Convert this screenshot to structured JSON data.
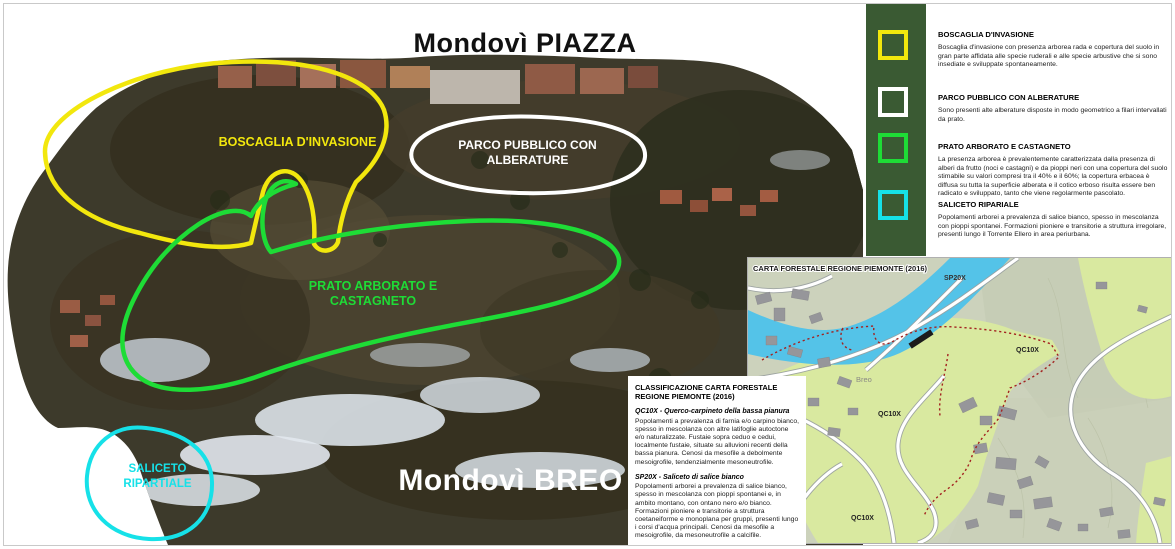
{
  "main_map": {
    "district_top_label": "Mondovì PIAZZA",
    "district_bottom_label": "Mondovì BREO",
    "regions": [
      {
        "label": "BOSCAGLIA D'INVASIONE",
        "color": "#f2e70d"
      },
      {
        "label": "PARCO PUBBLICO CON ALBERATURE",
        "color": "#ffffff"
      },
      {
        "label": "PRATO ARBORATO E CASTAGNETO",
        "color": "#1edc36"
      },
      {
        "label": "SALICETO RIPARTIALE",
        "color": "#16e1e8"
      }
    ]
  },
  "legend": {
    "panel_color": "#3a5a33",
    "items": [
      {
        "title": "BOSCAGLIA D'INVASIONE",
        "color": "#f2e70d",
        "description": "Boscaglia d'invasione con presenza arborea rada e copertura del suolo in gran parte affidata alle specie ruderali e alle specie arbustive che si sono insediate e sviluppate spontaneamente."
      },
      {
        "title": "PARCO PUBBLICO CON ALBERATURE",
        "color": "#ffffff",
        "description": "Sono presenti alte alberature disposte in modo geometrico a filari intervallati da prato."
      },
      {
        "title": "PRATO ARBORATO E CASTAGNETO",
        "color": "#1edc36",
        "description": "La presenza arborea è prevalentemente caratterizzata dalla presenza di alberi da frutto (noci e castagni) e da pioppi neri con una copertura del suolo stimabile su valori compresi tra il 40% e il 60%; la copertura erbacea è diffusa su tutta la superficie alberata e il cotico erboso risulta essere ben radicato e sviluppato, tanto che viene regolarmente pascolato."
      },
      {
        "title": "SALICETO RIPARIALE",
        "color": "#16e1e8",
        "description": "Popolamenti arborei a prevalenza di salice bianco, spesso in mescolanza con pioppi spontanei. Formazioni pioniere e transitorie a struttura irregolare, presenti lungo il Torrente Ellero in area periurbana."
      }
    ]
  },
  "classification_box": {
    "title": "CLASSIFICAZIONE CARTA FORESTALE REGIONE PIEMONTE (2016)",
    "entries": [
      {
        "heading": "QC10X - Querco-carpineto della bassa pianura",
        "description": "Popolamenti a prevalenza di farnia e/o carpino bianco, spesso in mescolanza con altre latifoglie autoctone e/o naturalizzate. Fustaie sopra ceduo e cedui, localmente fustaie, situate su alluvioni recenti della bassa pianura. Cenosi da mesofile a debolmente mesoigrofile, tendenzialmente mesoneutrofile."
      },
      {
        "heading": "SP20X - Saliceto di salice bianco",
        "description": "Popolamenti arborei a prevalenza di salice bianco, spesso in mescolanza con pioppi spontanei e, in ambito montano, con ontano nero e/o bianco. Formazioni pioniere e transitorie a struttura coetaneiforme e monoplana per gruppi, presenti lungo i corsi d'acqua principali. Cenosi da mesofile a mesoigrofile, da mesoneutrofile a calcifile."
      }
    ]
  },
  "inset_map": {
    "title": "CARTA FORESTALE REGIONE PIEMONTE (2016)",
    "zone_labels": {
      "sp20x": "SP20X",
      "qc10x": "QC10X",
      "breo": "Breo"
    },
    "colors": {
      "river": "#54c3e8",
      "forest_green": "#d9e9a0",
      "boundary_red": "#a32220"
    }
  }
}
